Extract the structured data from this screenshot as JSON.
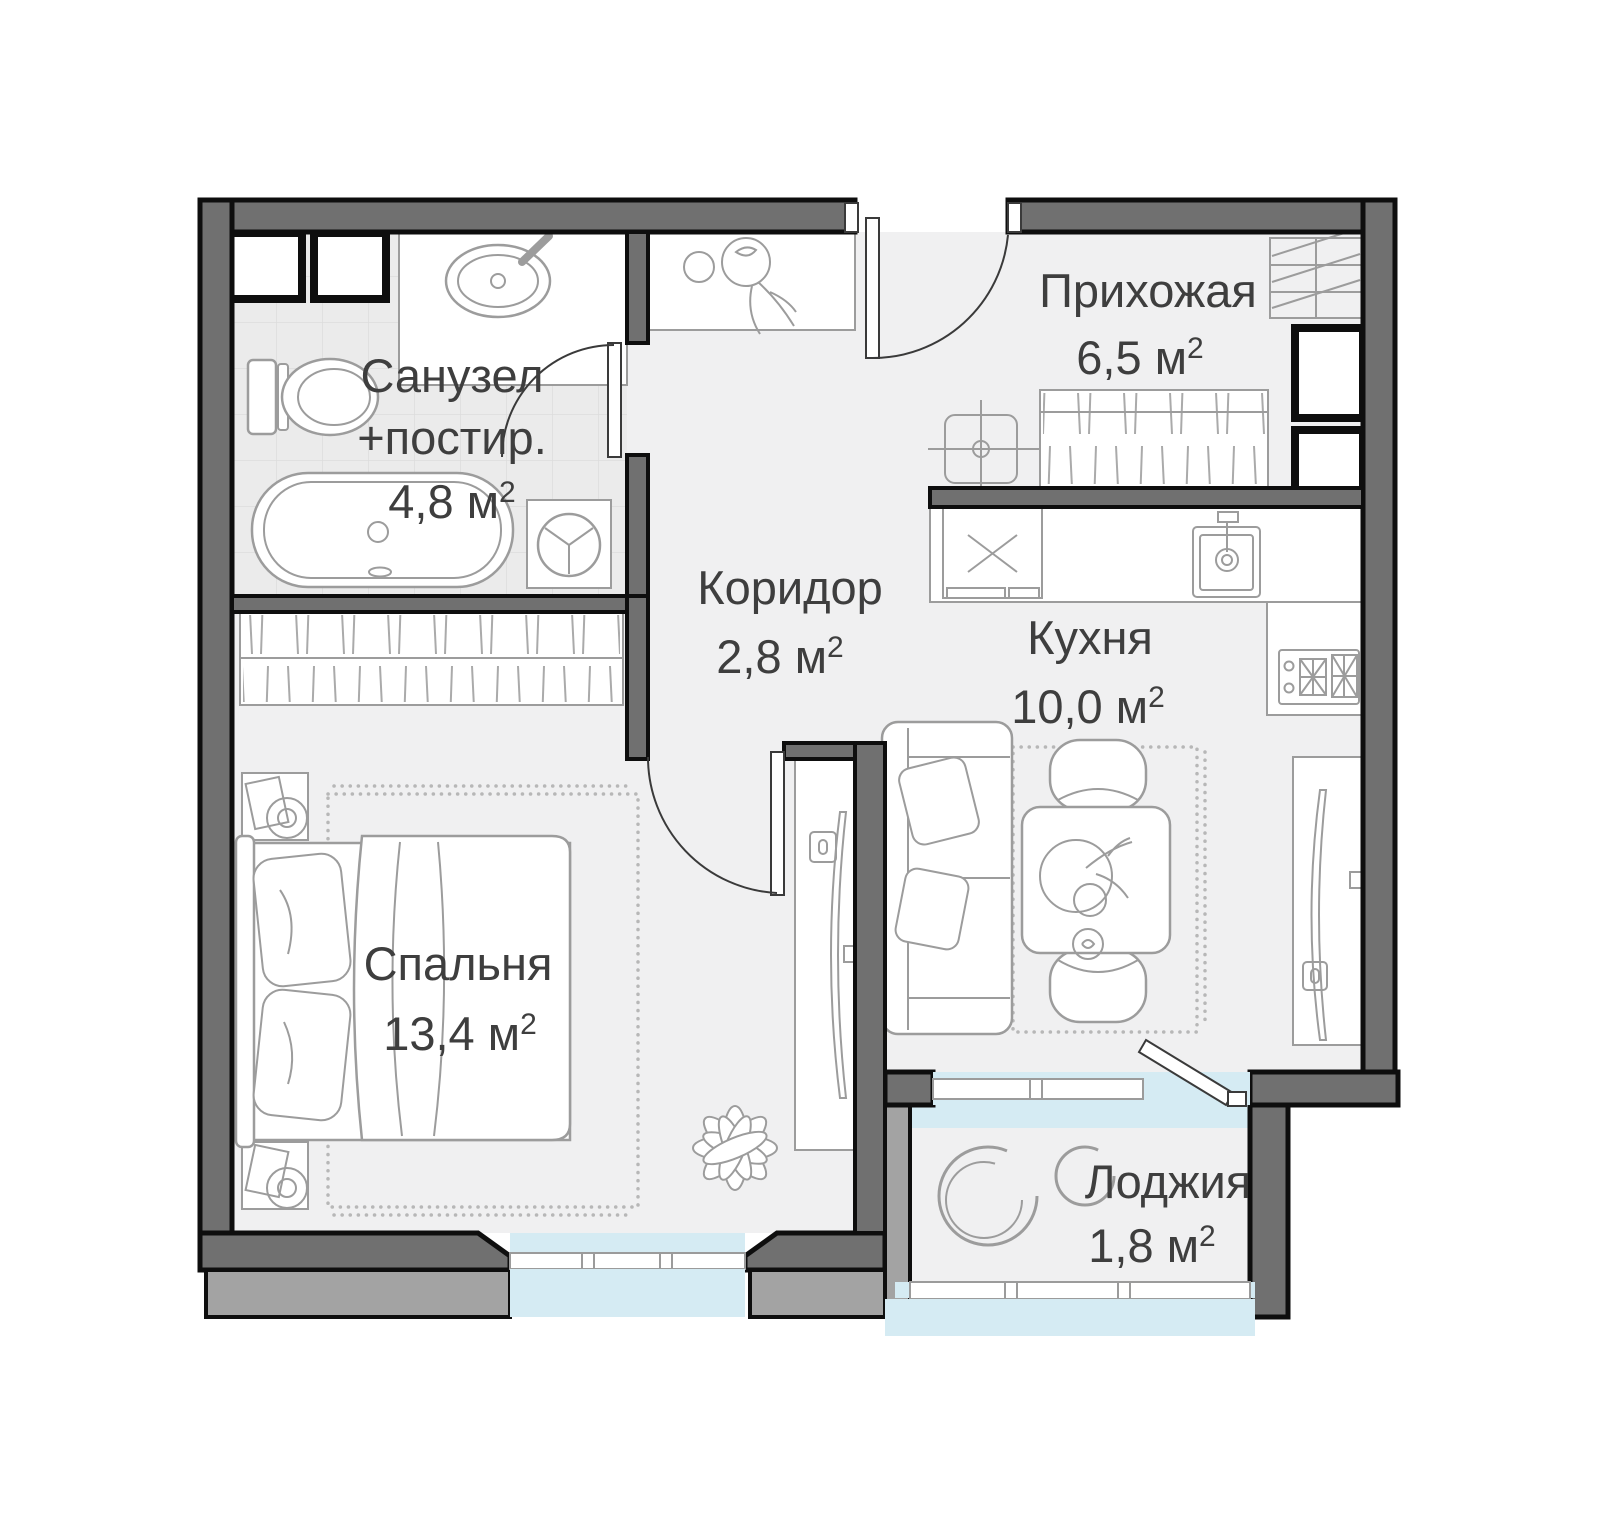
{
  "plan": {
    "title": "Apartment floor plan",
    "rooms": {
      "bathroom": {
        "name_line1": "Санузел",
        "name_line2": "+постир.",
        "area": "4,8 м",
        "area_sup": "2"
      },
      "hallway": {
        "name": "Прихожая",
        "area": "6,5 м",
        "area_sup": "2"
      },
      "corridor": {
        "name": "Коридор",
        "area": "2,8 м",
        "area_sup": "2"
      },
      "kitchen": {
        "name": "Кухня",
        "area": "10,0 м",
        "area_sup": "2"
      },
      "bedroom": {
        "name": "Спальня",
        "area": "13,4 м",
        "area_sup": "2"
      },
      "loggia": {
        "name": "Лоджия",
        "area": "1,8 м",
        "area_sup": "2"
      }
    },
    "colors": {
      "background": "#ffffff",
      "wall_dark": "#707070",
      "wall_light": "#a3a3a3",
      "outline": "#0e0e0e",
      "floor": "#f0f0f1",
      "tile": "#ebebeb",
      "glazing": "#d5ebf3",
      "furniture": "#9c9c9c",
      "text": "#3e3e3e"
    }
  }
}
